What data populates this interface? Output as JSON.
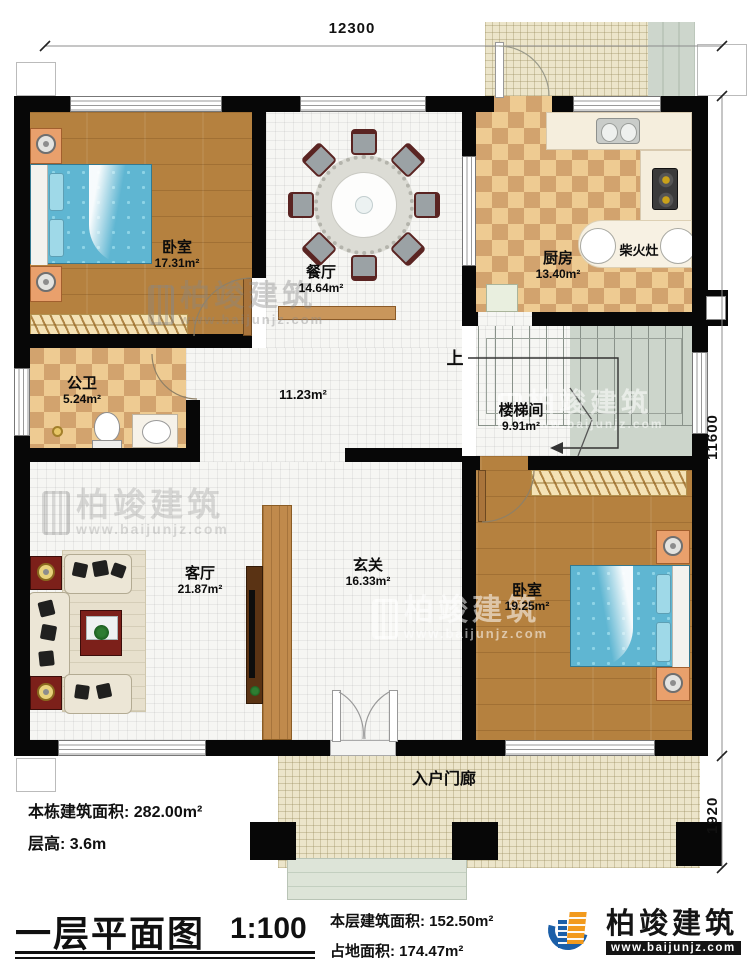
{
  "dimensions": {
    "top": "12300",
    "right_upper": "11600",
    "right_lower": "1920"
  },
  "rooms": {
    "bedroom1": {
      "name": "卧室",
      "area": "17.31m²"
    },
    "dining": {
      "name": "餐厅",
      "area": "14.64m²"
    },
    "kitchen": {
      "name": "厨房",
      "area": "13.40m²"
    },
    "wood_stove": {
      "name": "柴火灶"
    },
    "bathroom": {
      "name": "公卫",
      "area": "5.24m²"
    },
    "hallway": {
      "area": "11.23m²"
    },
    "stairwell": {
      "name": "楼梯间",
      "area": "9.91m²",
      "up_label": "上"
    },
    "living": {
      "name": "客厅",
      "area": "21.87m²"
    },
    "foyer": {
      "name": "玄关",
      "area": "16.33m²"
    },
    "bedroom2": {
      "name": "卧室",
      "area": "19.25m²"
    },
    "entry_porch": {
      "name": "入户门廊"
    }
  },
  "annotations": {
    "total_area": "本栋建筑面积: 282.00m²",
    "floor_height": "层高: 3.6m"
  },
  "titleblock": {
    "title": "一层平面图",
    "scale": "1:100",
    "floor_area": "本层建筑面积: 152.50m²",
    "land_area": "占地面积: 174.47m²"
  },
  "brand": {
    "name": "柏竣建筑",
    "website": "www.baijunjz.com"
  },
  "watermark": {
    "name": "柏竣建筑",
    "website": "www.baijunjz.com"
  }
}
